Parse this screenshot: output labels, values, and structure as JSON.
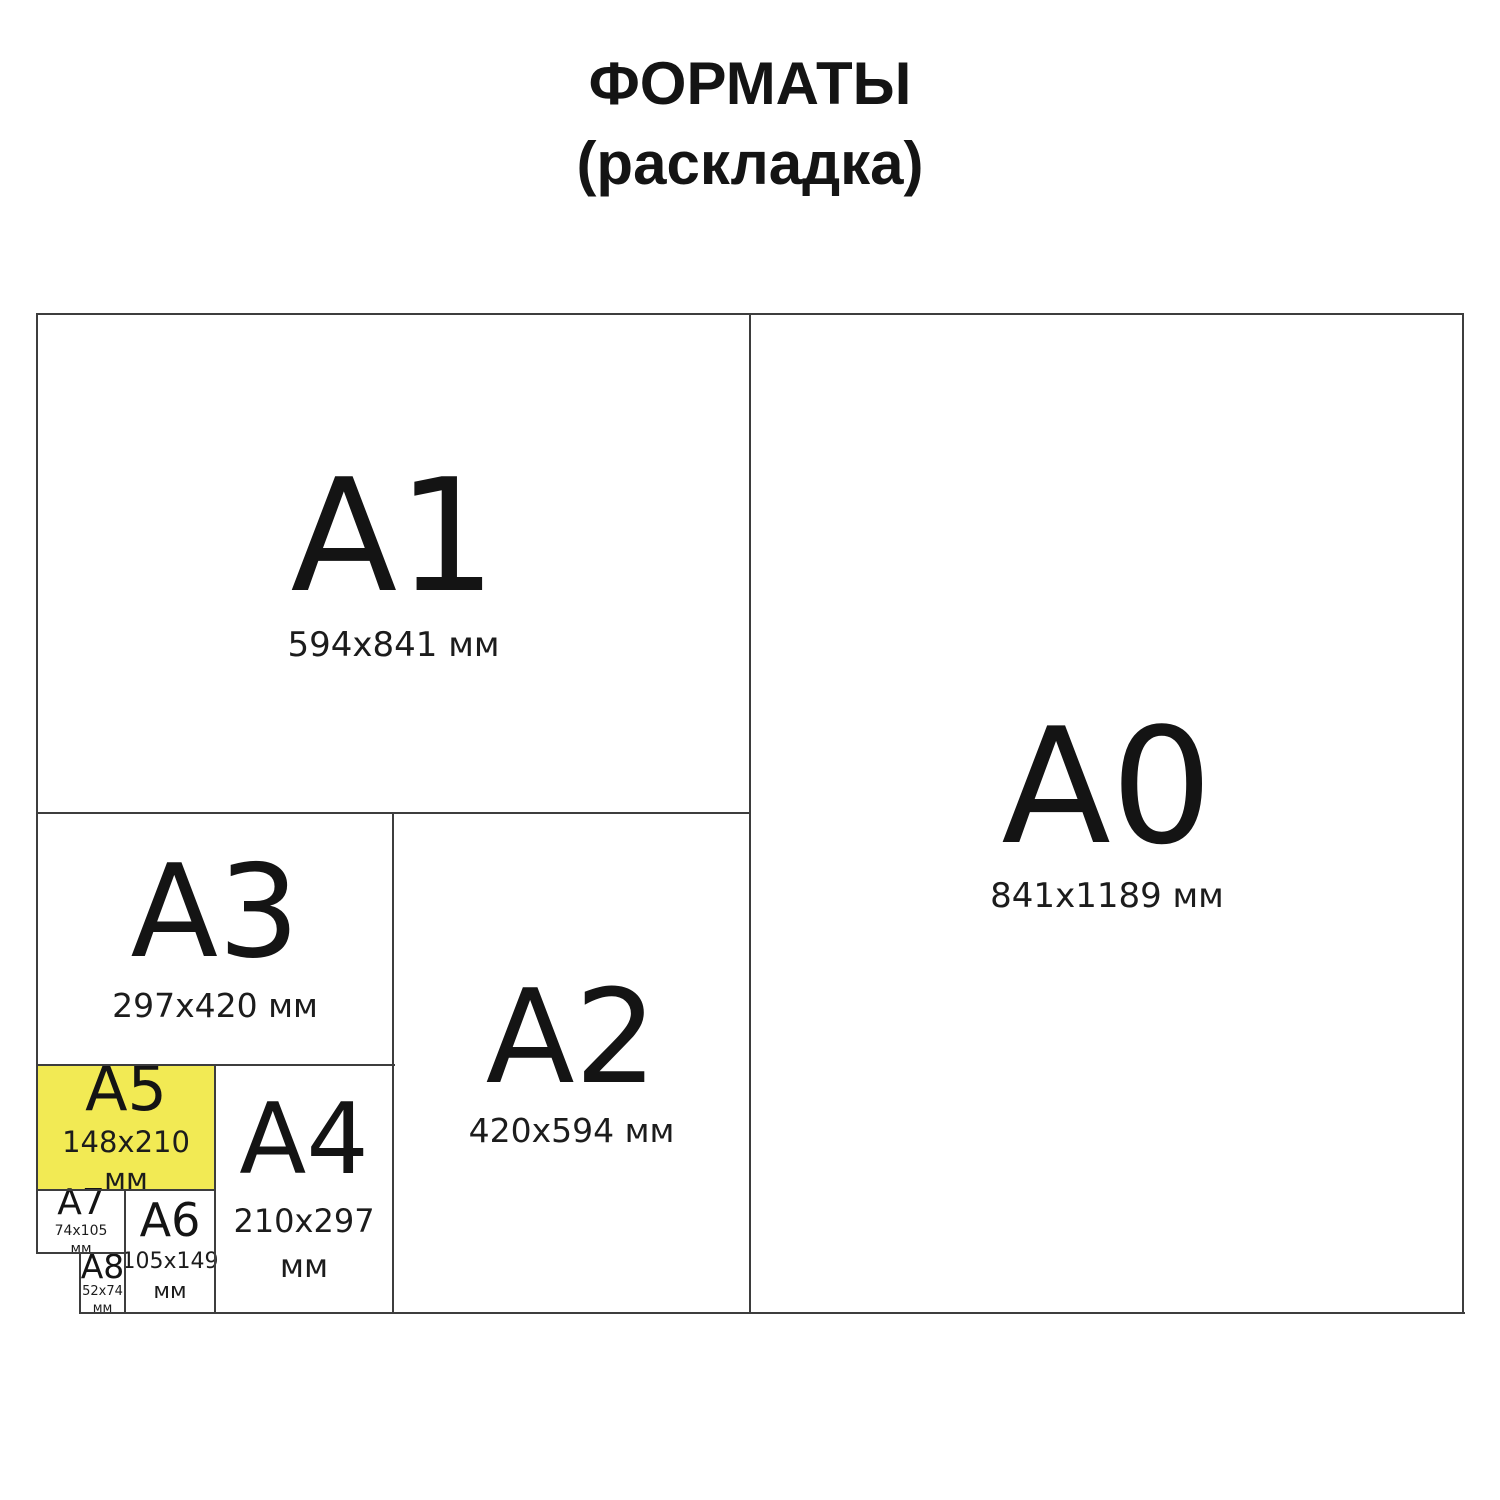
{
  "title": {
    "line1": "ФОРМАТЫ",
    "line2": "(раскладка)"
  },
  "colors": {
    "highlight_yellow": "#f2ea54",
    "border": "#3d3d3d",
    "text": "#161616",
    "background": "#ffffff"
  },
  "formats": {
    "a0": {
      "label": "A0",
      "size": "841x1189 мм"
    },
    "a1": {
      "label": "A1",
      "size": "594x841 мм"
    },
    "a2": {
      "label": "A2",
      "size": "420x594 мм"
    },
    "a3": {
      "label": "A3",
      "size": "297x420 мм"
    },
    "a4": {
      "label": "A4",
      "size": "210x297",
      "unit": "мм"
    },
    "a5": {
      "label": "A5",
      "size": "148x210",
      "unit": "мм",
      "highlighted": true
    },
    "a6": {
      "label": "A6",
      "size": "105x149",
      "unit": "мм"
    },
    "a7": {
      "label": "A7",
      "size": "74x105",
      "unit": "мм"
    },
    "a8": {
      "label": "A8",
      "size": "52x74",
      "unit": "мм"
    }
  }
}
